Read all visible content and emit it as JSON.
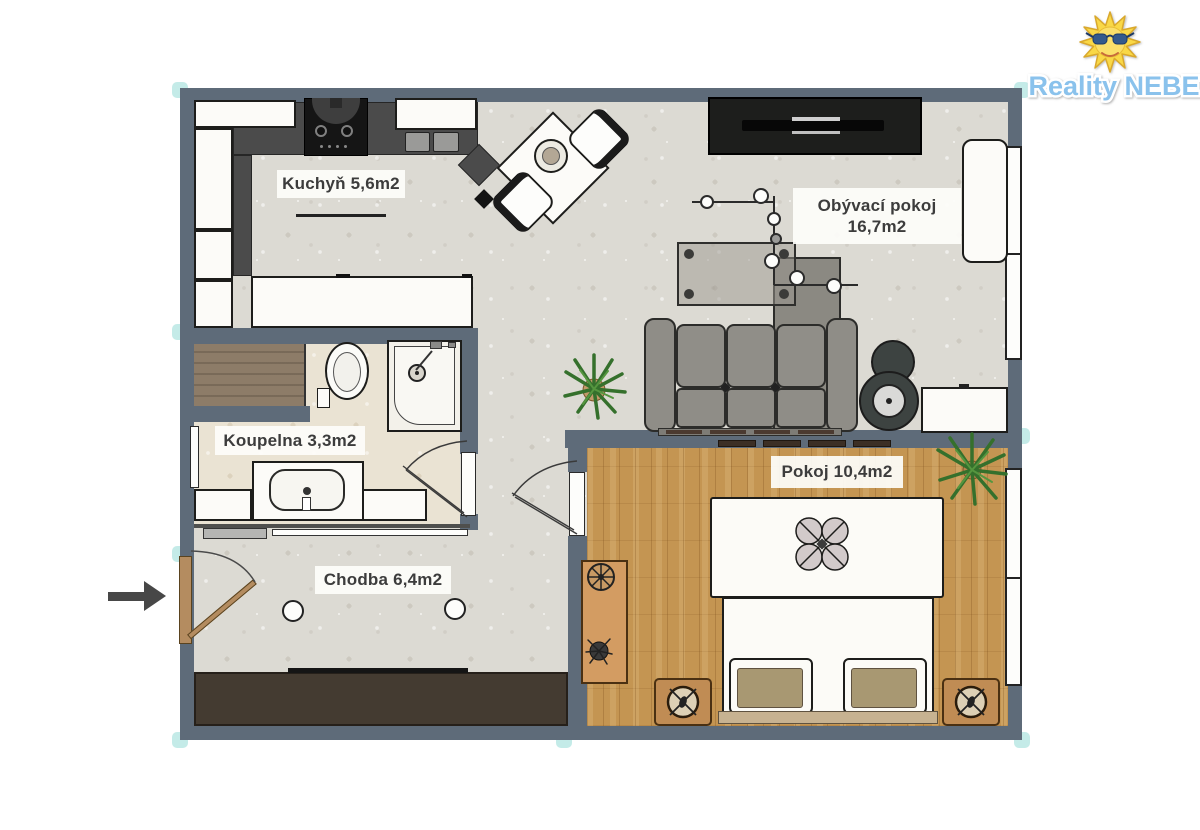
{
  "logo": {
    "text": "Reality NEBE"
  },
  "rooms": [
    {
      "id": "kitchen",
      "label": "Kuchyň 5,6m2"
    },
    {
      "id": "living-room",
      "label": "Obývací pokoj",
      "area": "16,7m2"
    },
    {
      "id": "bathroom",
      "label": "Koupelna 3,3m2"
    },
    {
      "id": "hallway",
      "label": "Chodba 6,4m2"
    },
    {
      "id": "bedroom",
      "label": "Pokoj 10,4m2"
    }
  ],
  "colors": {
    "wall": "#5e6b79",
    "brand_blue": "#8ac2ec",
    "sun_yellow": "#f9d847",
    "accent_teal": "#93dbd5",
    "wood_floor": "#c49552"
  }
}
